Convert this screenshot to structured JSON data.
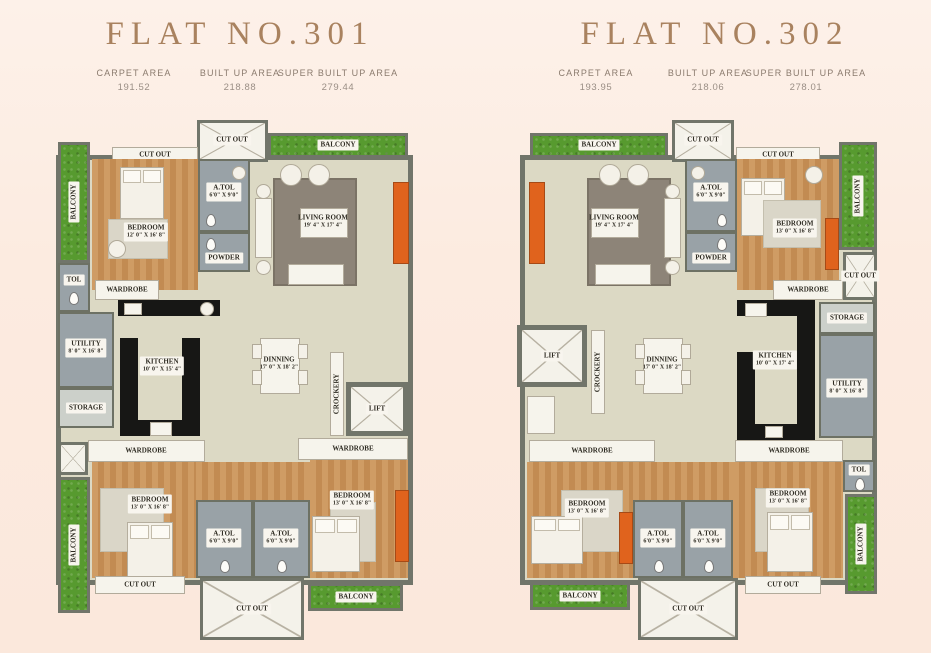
{
  "colors": {
    "background": "#fcebe0",
    "title_text": "#a9825f",
    "wall": "#71756a",
    "wood_floor": "#c8935a",
    "tile_floor": "#99a2a7",
    "grass": "#579a2f",
    "interior_floor": "#dcd9c4",
    "accent_orange": "#e0631d"
  },
  "shared": {
    "balcony": "BALCONY",
    "cut_out": "CUT OUT",
    "wardrobe": "WARDROBE",
    "atol": "A.TOL",
    "atol_dims": "6'0\" X 9'0\"",
    "tol": "TOL",
    "powder": "POWDER",
    "storage": "STORAGE",
    "utility": "UTILITY",
    "utility_dims": "8' 0\" X 16' 8\"",
    "crockery": "CROCKERY",
    "lift": "LIFT",
    "kitchen": "KITCHEN",
    "dinning": "DINNING",
    "dinning_dims": "17' 0\" X 18' 2\"",
    "living_room": "LIVING ROOM",
    "living_room_dims": "19' 4\" X 17' 4\"",
    "bedroom": "BEDROOM",
    "bedroom_dims_13": "13' 0\" X 16' 8\""
  },
  "flat301": {
    "title": "FLAT NO.301",
    "stats": [
      {
        "label": "CARPET AREA",
        "value": "191.52"
      },
      {
        "label": "BUILT UP AREA",
        "value": "218.88"
      },
      {
        "label": "SUPER BUILT UP AREA",
        "value": "279.44"
      }
    ],
    "bedroom_top_dims": "12' 0\" X 16' 8\"",
    "kitchen_dims": "10' 0\" X 15' 4\""
  },
  "flat302": {
    "title": "FLAT NO.302",
    "stats": [
      {
        "label": "CARPET AREA",
        "value": "193.95"
      },
      {
        "label": "BUILT UP AREA",
        "value": "218.06"
      },
      {
        "label": "SUPER BUILT UP AREA",
        "value": "278.01"
      }
    ],
    "bedroom_top_dims": "13' 0\" X 16' 8\"",
    "kitchen_dims": "10' 0\" X 17' 4\""
  }
}
